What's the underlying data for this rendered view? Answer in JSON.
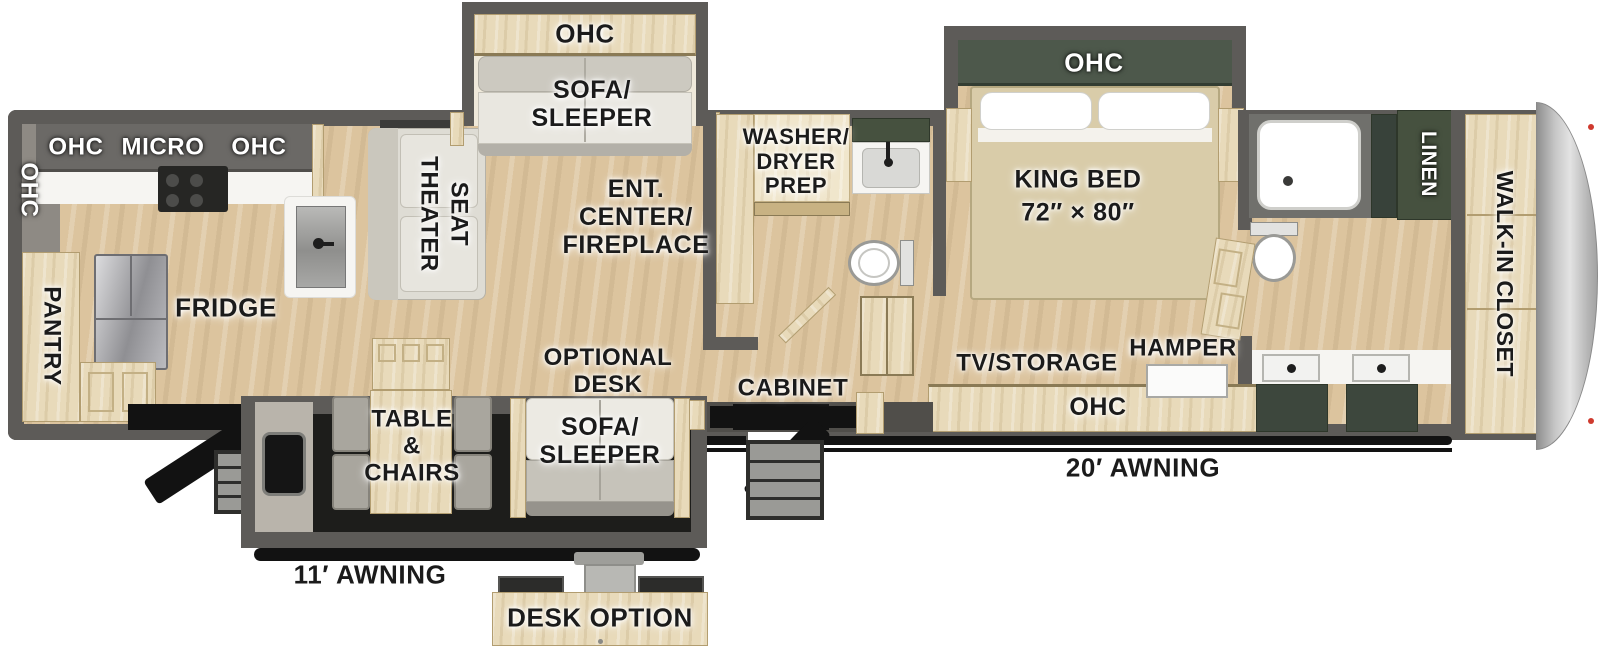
{
  "labels": {
    "kitchen": {
      "ohc_side": "OHC",
      "ohc_top": "OHC",
      "micro": "MICRO",
      "ohc_top2": "OHC",
      "pantry": "PANTRY",
      "fridge": "FRIDGE"
    },
    "living": {
      "theater_line1": "THEATER",
      "theater_line2": "SEAT",
      "slide_ohc": "OHC",
      "slide_sofa": "SOFA/\nSLEEPER",
      "ent_center": "ENT.\nCENTER/\nFIREPLACE",
      "optional_desk": "OPTIONAL\nDESK",
      "sofa_sleeper": "SOFA/\nSLEEPER",
      "table_chairs": "TABLE\n&\nCHAIRS",
      "cabinet": "CABINET"
    },
    "bath": {
      "washer_dryer": "WASHER/\nDRYER\nPREP"
    },
    "bedroom": {
      "slide_ohc": "OHC",
      "king_bed": "KING BED\n72″ × 80″",
      "tv_storage": "TV/STORAGE",
      "hamper": "HAMPER",
      "ohc": "OHC"
    },
    "bath2": {
      "linen": "LINEN"
    },
    "closet": {
      "walk_in": "WALK-IN CLOSET"
    },
    "exterior": {
      "awning_short": "11′ AWNING",
      "awning_long": "20′ AWNING",
      "desk_option": "DESK OPTION"
    }
  },
  "colors": {
    "wall": "#5d5b58",
    "floor_wood": "#dcc49e",
    "cabinet_wood": "#e8daba",
    "dark_green": "#46513f",
    "counter_white": "#f6f5f2",
    "awning_black": "#121212",
    "cap_silver": "#c9c9c9",
    "marker_red": "#cf3a2e",
    "sofa_fabric": "#e9e7e0",
    "label_black": "#1b1b1b"
  }
}
